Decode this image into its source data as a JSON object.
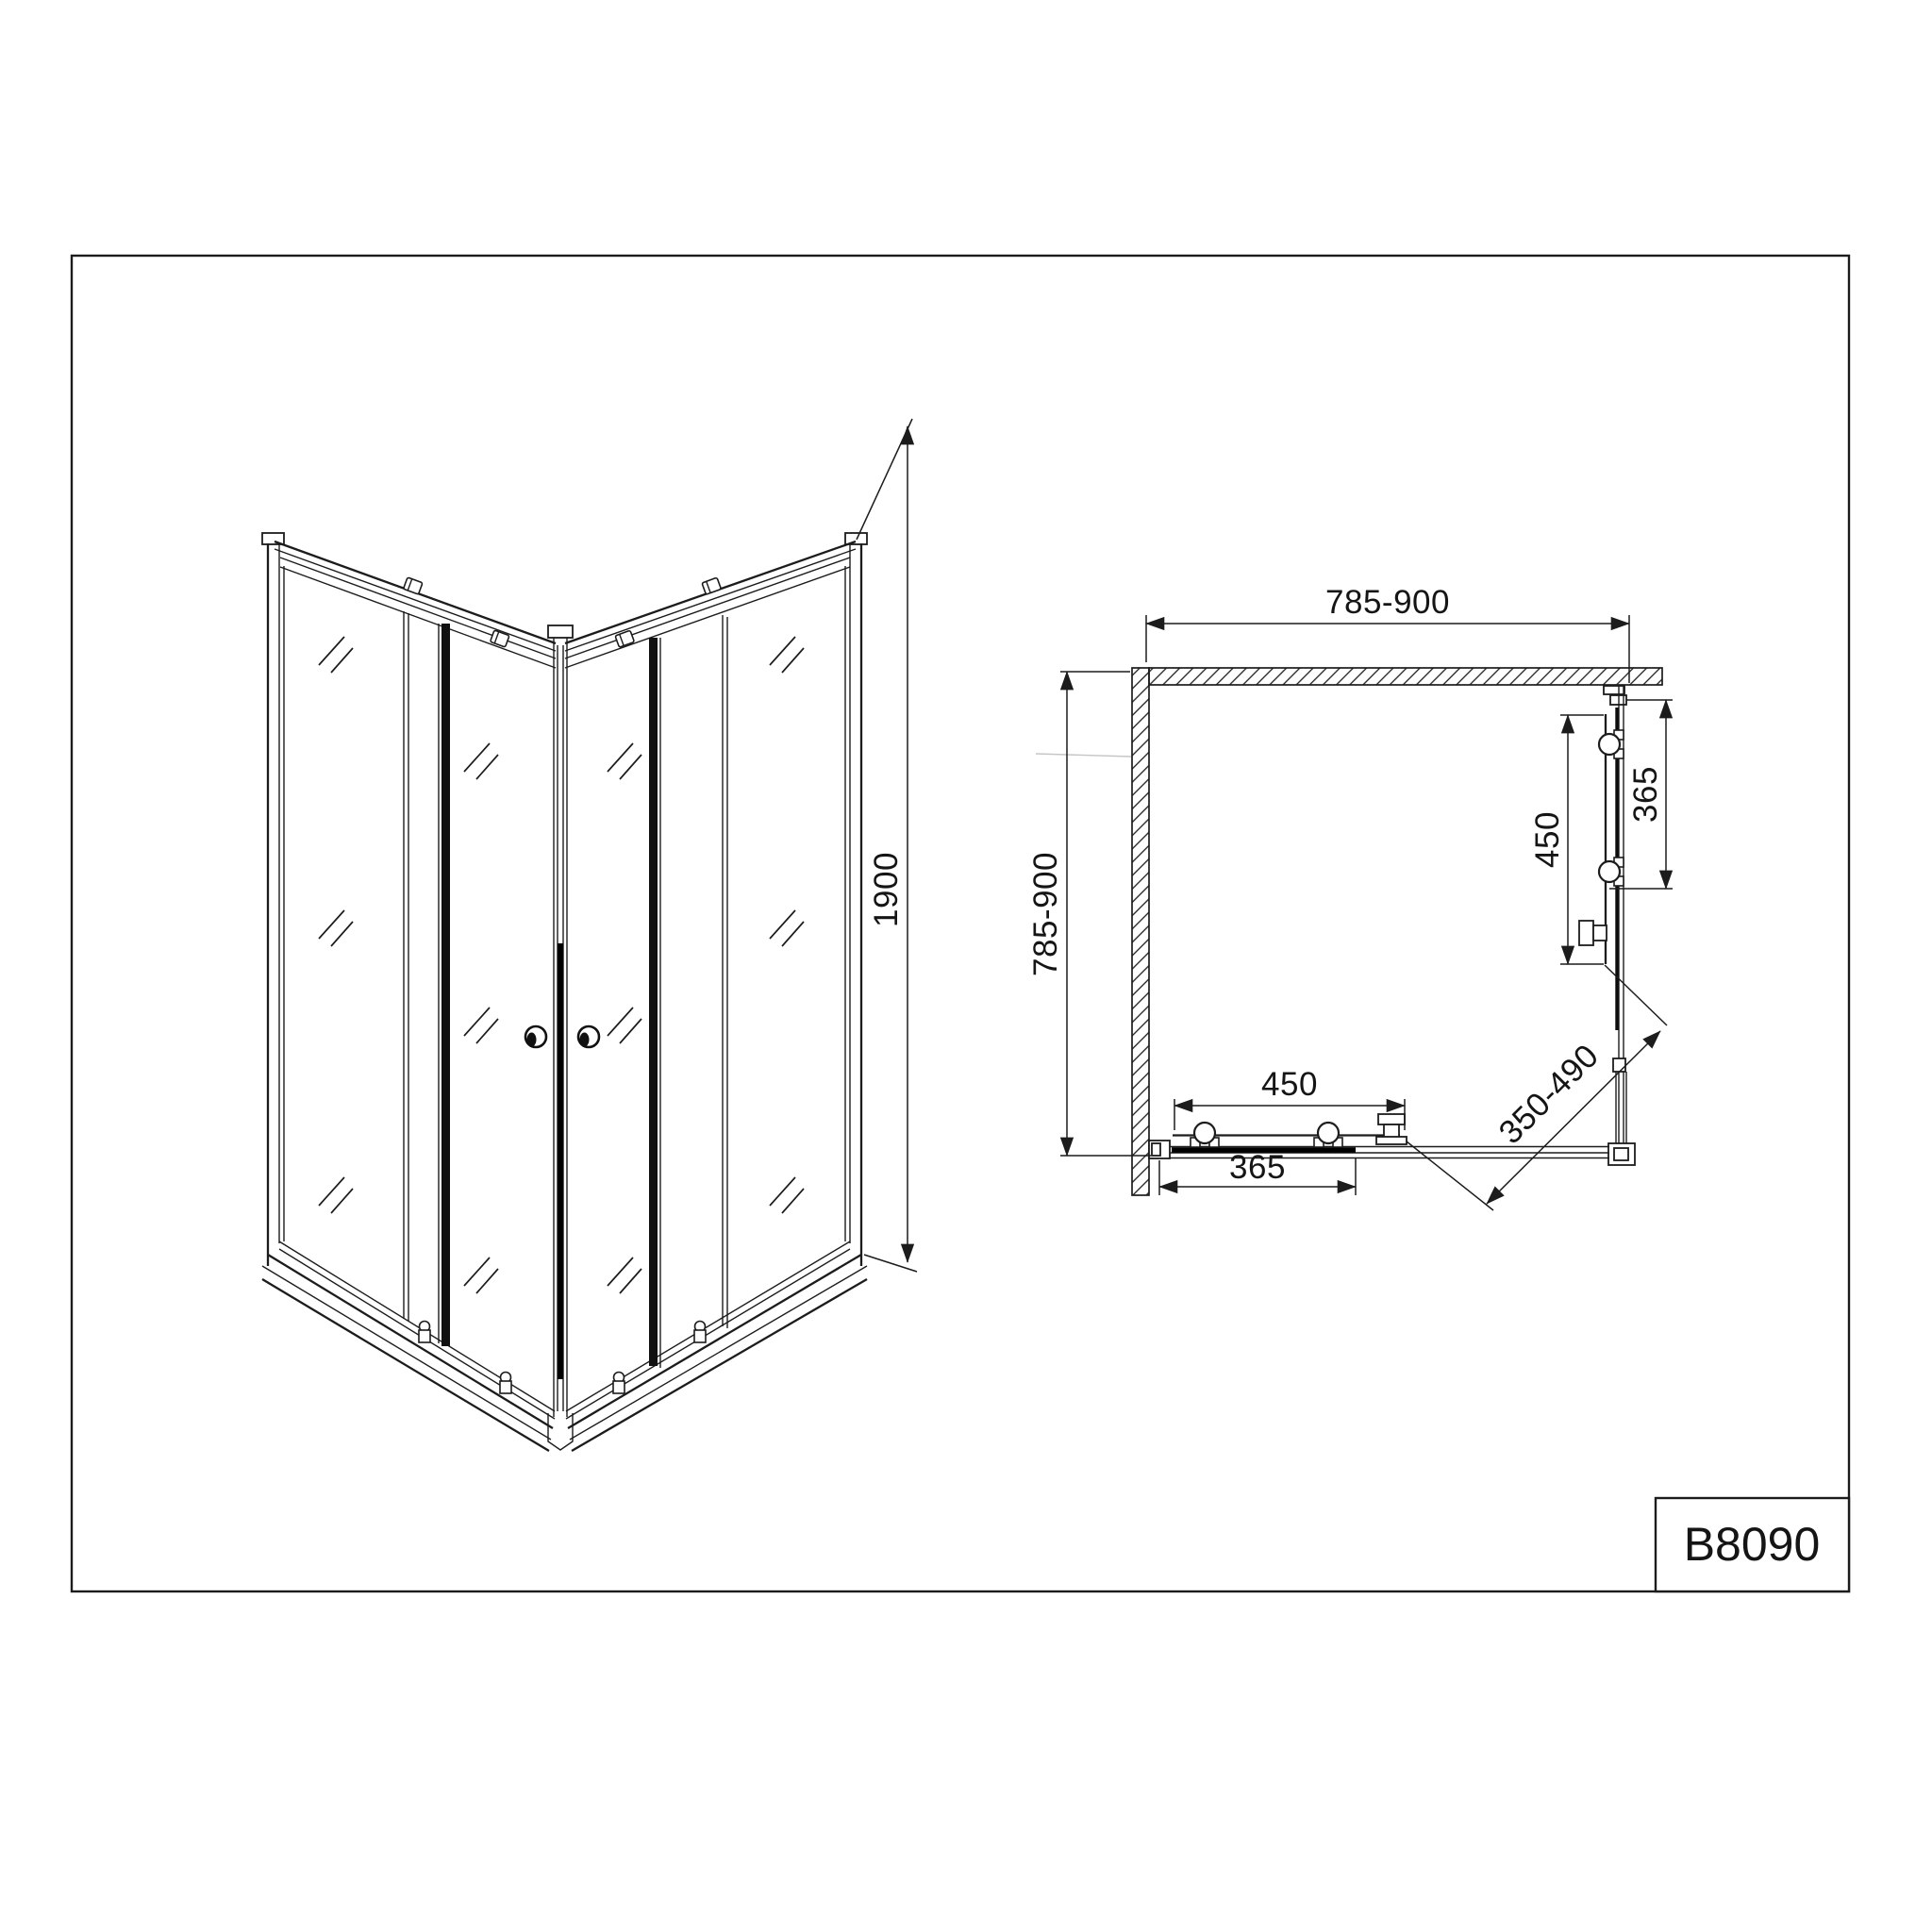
{
  "model": {
    "label": "B8090"
  },
  "front_view": {
    "height_dim": "1900"
  },
  "plan_view": {
    "width_dim": "785-900",
    "depth_dim": "785-900",
    "side_door_dim": "450",
    "side_panel_dim": "365",
    "front_door_dim": "450",
    "front_panel_dim": "365",
    "diagonal_dim": "350-490"
  }
}
